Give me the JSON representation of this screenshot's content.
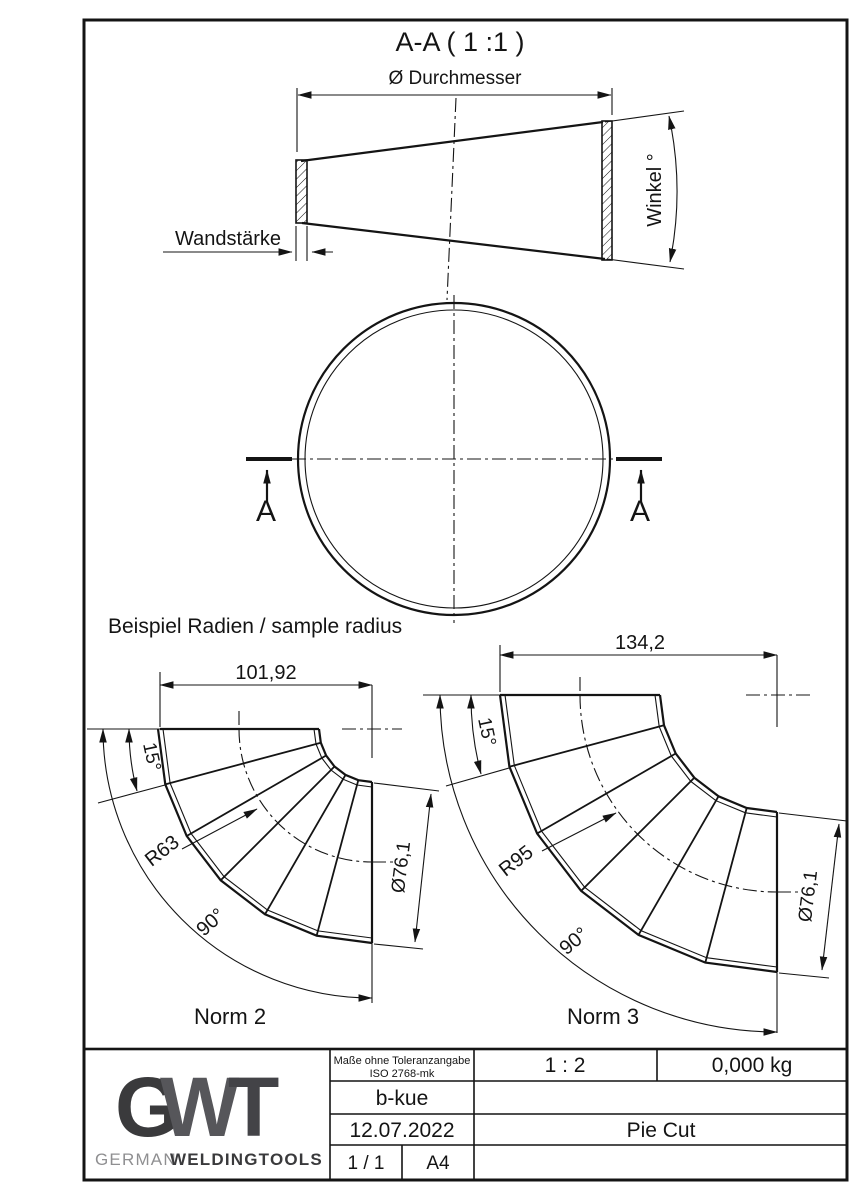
{
  "colors": {
    "line": "#141414",
    "logo_dark": "#3a3a3c",
    "logo_mid": "#56565a",
    "brand_gray": "#8f8f91"
  },
  "drawing": {
    "section_title": "A-A ( 1 :1 )",
    "labels": {
      "diameter": "Ø Durchmesser",
      "wall": "Wandstärke",
      "angle": "Winkel °",
      "section_marker": "A"
    },
    "sample_heading": "Beispiel Radien / sample radius",
    "elbows": [
      {
        "name": "Norm 2",
        "width": "101,92",
        "segment_angle": "15°",
        "radius": "R63",
        "bend_angle": "90°",
        "diameter": "Ø76,1"
      },
      {
        "name": "Norm 3",
        "width": "134,2",
        "segment_angle": "15°",
        "radius": "R95",
        "bend_angle": "90°",
        "diameter": "Ø76,1"
      }
    ]
  },
  "title_block": {
    "tolerance_line1": "Maße ohne Toleranzangabe",
    "tolerance_line2": "ISO 2768-mk",
    "scale": "1 : 2",
    "weight": "0,000 kg",
    "author": "b-kue",
    "date": "12.07.2022",
    "part_title": "Pie Cut",
    "sheet": "1 / 1",
    "format": "A4",
    "logo_g": "G",
    "logo_w": "W",
    "logo_t": "T",
    "brand_light": "GERMAN",
    "brand_bold": "WELDINGTOOLS"
  }
}
